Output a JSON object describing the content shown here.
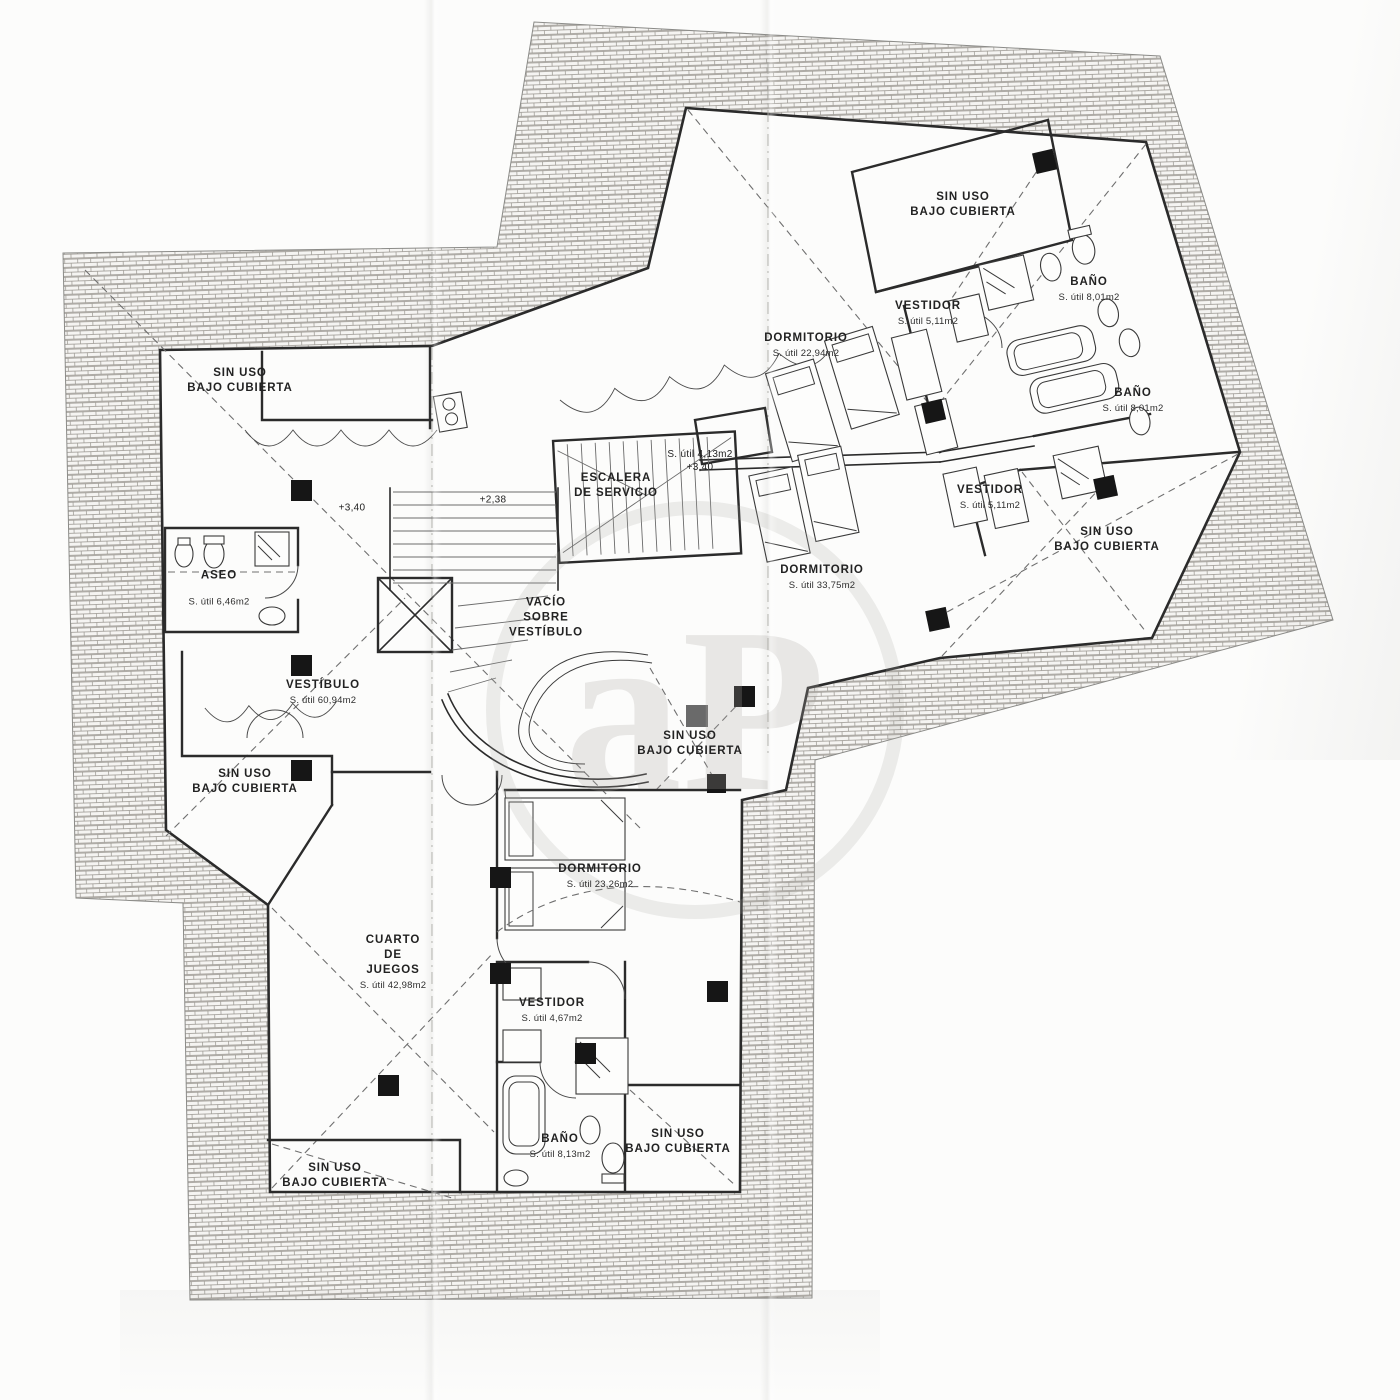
{
  "document": {
    "type": "floor-plan",
    "language": "es"
  },
  "colors": {
    "paper": "#fcfcfb",
    "ink": "#2b2b2b",
    "hatch_base": "#f5f4f2",
    "hatch_line": "#98958f",
    "dashed_line": "#6f6f6f",
    "column_marker": "#161616",
    "watermark": "#aca9a3"
  },
  "watermark": {
    "text": "aP"
  },
  "labels": [
    {
      "id": "sin-uso-wing-top",
      "l1": "SIN USO",
      "l2": "BAJO CUBIERTA",
      "x": 963,
      "y": 205
    },
    {
      "id": "bano-1",
      "l1": "BAÑO",
      "area": "S. útil 8,01m2",
      "x": 1089,
      "y": 289
    },
    {
      "id": "vestidor-1",
      "l1": "VESTIDOR",
      "area": "S. útil 5,11m2",
      "x": 928,
      "y": 313
    },
    {
      "id": "dormitorio-1",
      "l1": "DORMITORIO",
      "area": "S. útil 22,94m2",
      "x": 806,
      "y": 345
    },
    {
      "id": "bano-2",
      "l1": "BAÑO",
      "area": "S. útil 8,01m2",
      "x": 1133,
      "y": 400
    },
    {
      "id": "cuarto-util-413",
      "l1": "S. útil 4,13m2",
      "l2": "+3,40",
      "x": 700,
      "y": 461
    },
    {
      "id": "escalera-servicio",
      "l1": "ESCALERA",
      "l2": "DE SERVICIO",
      "x": 616,
      "y": 486
    },
    {
      "id": "nivel-340",
      "l1": "+3,40",
      "x": 352,
      "y": 508
    },
    {
      "id": "nivel-238",
      "l1": "+2,38",
      "x": 493,
      "y": 500
    },
    {
      "id": "vestidor-2",
      "l1": "VESTIDOR",
      "area": "S. útil 5,11m2",
      "x": 990,
      "y": 497
    },
    {
      "id": "sin-uso-wing-right",
      "l1": "SIN USO",
      "l2": "BAJO CUBIERTA",
      "x": 1107,
      "y": 540
    },
    {
      "id": "sin-uso-top-left",
      "l1": "SIN USO",
      "l2": "BAJO CUBIERTA",
      "x": 240,
      "y": 381
    },
    {
      "id": "aseo",
      "l1": "ASEO",
      "area": "S. útil 6,46m2",
      "x": 219,
      "y": 588
    },
    {
      "id": "vacio-sobre-vestibulo",
      "l1": "VACÍO",
      "l2": "SOBRE",
      "l3": "VESTÍBULO",
      "x": 546,
      "y": 618
    },
    {
      "id": "dormitorio-2",
      "l1": "DORMITORIO",
      "area": "S. útil 33,75m2",
      "x": 822,
      "y": 577
    },
    {
      "id": "vestibulo",
      "l1": "VESTÍBULO",
      "area": "S. útil 60,94m2",
      "x": 323,
      "y": 692
    },
    {
      "id": "sin-uso-left",
      "l1": "SIN USO",
      "l2": "BAJO CUBIERTA",
      "x": 245,
      "y": 782
    },
    {
      "id": "sin-uso-center",
      "l1": "SIN USO",
      "l2": "BAJO CUBIERTA",
      "x": 690,
      "y": 744
    },
    {
      "id": "dormitorio-3",
      "l1": "DORMITORIO",
      "area": "S. útil 23,26m2",
      "x": 600,
      "y": 876
    },
    {
      "id": "cuarto-de-juegos",
      "l1": "CUARTO",
      "l2": "DE",
      "l3": "JUEGOS",
      "area": "S. útil 42,98m2",
      "x": 393,
      "y": 962
    },
    {
      "id": "vestidor-3",
      "l1": "VESTIDOR",
      "area": "S. útil 4,67m2",
      "x": 552,
      "y": 1010
    },
    {
      "id": "bano-3",
      "l1": "BAÑO",
      "area": "S. útil 8,13m2",
      "x": 560,
      "y": 1146
    },
    {
      "id": "sin-uso-bottom-right",
      "l1": "SIN USO",
      "l2": "BAJO CUBIERTA",
      "x": 678,
      "y": 1142
    },
    {
      "id": "sin-uso-bottom-left",
      "l1": "SIN USO",
      "l2": "BAJO CUBIERTA",
      "x": 335,
      "y": 1176
    }
  ]
}
